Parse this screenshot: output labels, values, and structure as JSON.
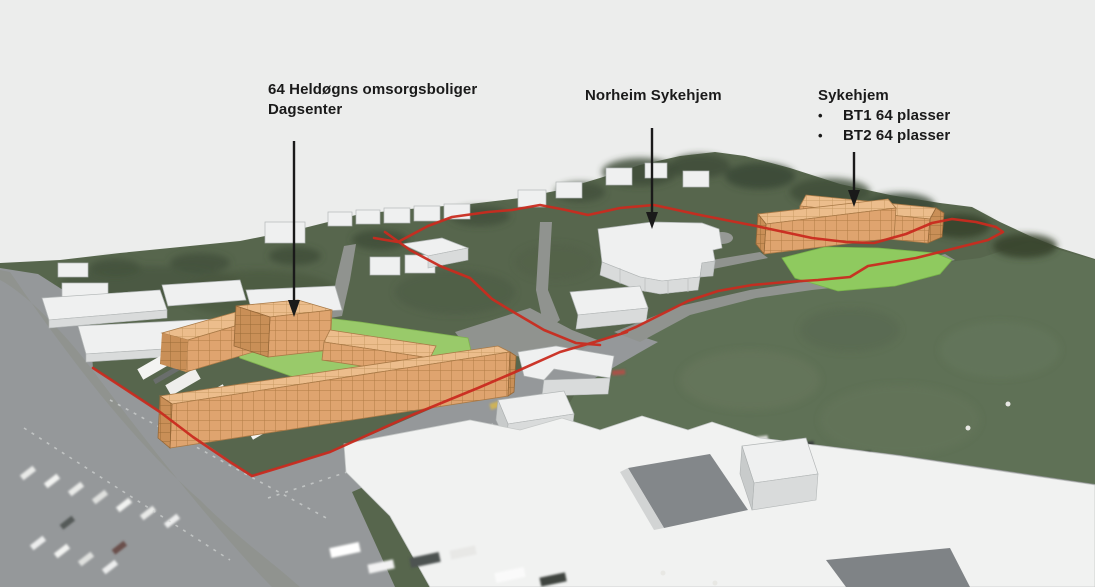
{
  "annotations": {
    "omsorgsboliger": {
      "line1": "64 Heldøgns omsorgsboliger",
      "line2": "Dagsenter"
    },
    "norheim": {
      "label": "Norheim Sykehjem"
    },
    "sykehjem": {
      "title": "Sykehjem",
      "bullet": "•",
      "items": [
        "BT1 64 plasser",
        "BT2 64 plasser"
      ]
    }
  },
  "colors": {
    "proposed_building_roof": "#ECBD8C",
    "proposed_building_front": "#DFA46F",
    "proposed_building_side": "#C98F57",
    "green_space": "#99CA6A",
    "lawn": "#8FCA5F",
    "site_boundary": "#C92B1F",
    "existing_building": "#F0F1F1",
    "terrain_hill": "#57664D",
    "terrain_field": "#5F7156",
    "asphalt": "#95989A",
    "annotation_text": "#1A1A1A",
    "sky": "#ECEDEC"
  }
}
